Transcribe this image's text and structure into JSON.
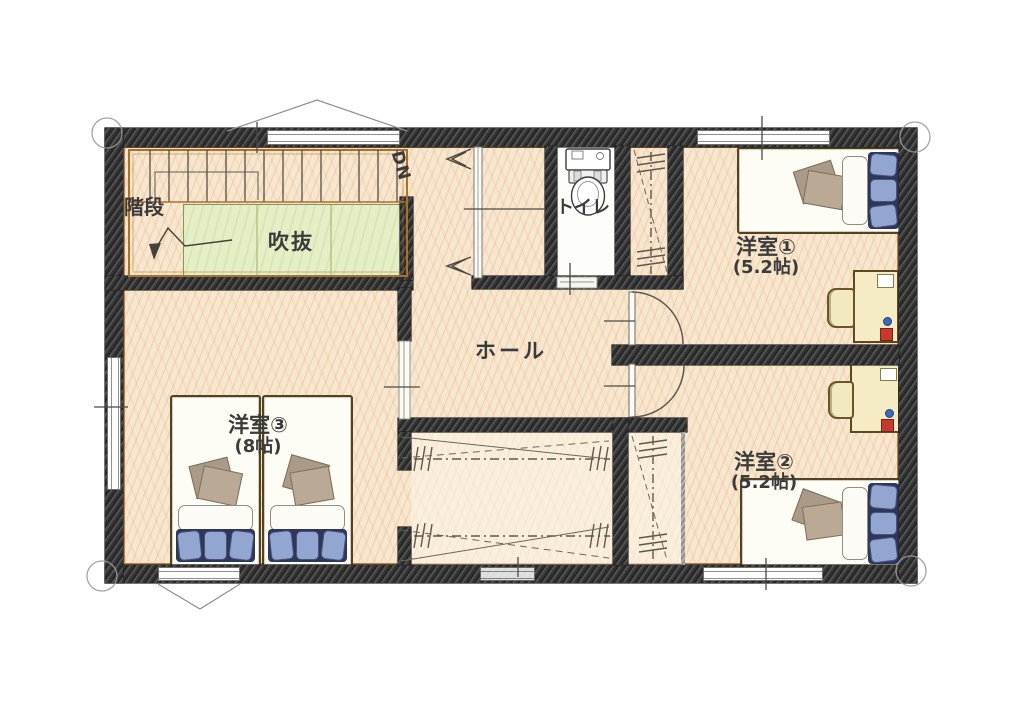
{
  "plan": {
    "type": "hand-drawn floor plan (2nd floor)",
    "rooms": {
      "stairs": {
        "label": "階段"
      },
      "void": {
        "label": "吹抜"
      },
      "dn": {
        "label": "DN"
      },
      "toilet": {
        "label": "トイレ"
      },
      "hall": {
        "label": "ホール"
      },
      "bedroom1": {
        "label": "洋室①",
        "size": "(5.2帖)"
      },
      "bedroom2": {
        "label": "洋室②",
        "size": "(5.2帖)"
      },
      "bedroom3": {
        "label": "洋室③",
        "size": "(8帖)"
      }
    },
    "colors": {
      "floor": "#f8e6ce",
      "wall": "#3a3a3a",
      "void_area": "#e5efc6",
      "trim_brown": "#a9712e",
      "blanket_blue": "#93a6d1",
      "blanket_dark": "#2e3757",
      "desk_yellow": "#f5ecc6",
      "accent_red": "#c53a2c",
      "accent_blue": "#3a6cb5"
    }
  }
}
